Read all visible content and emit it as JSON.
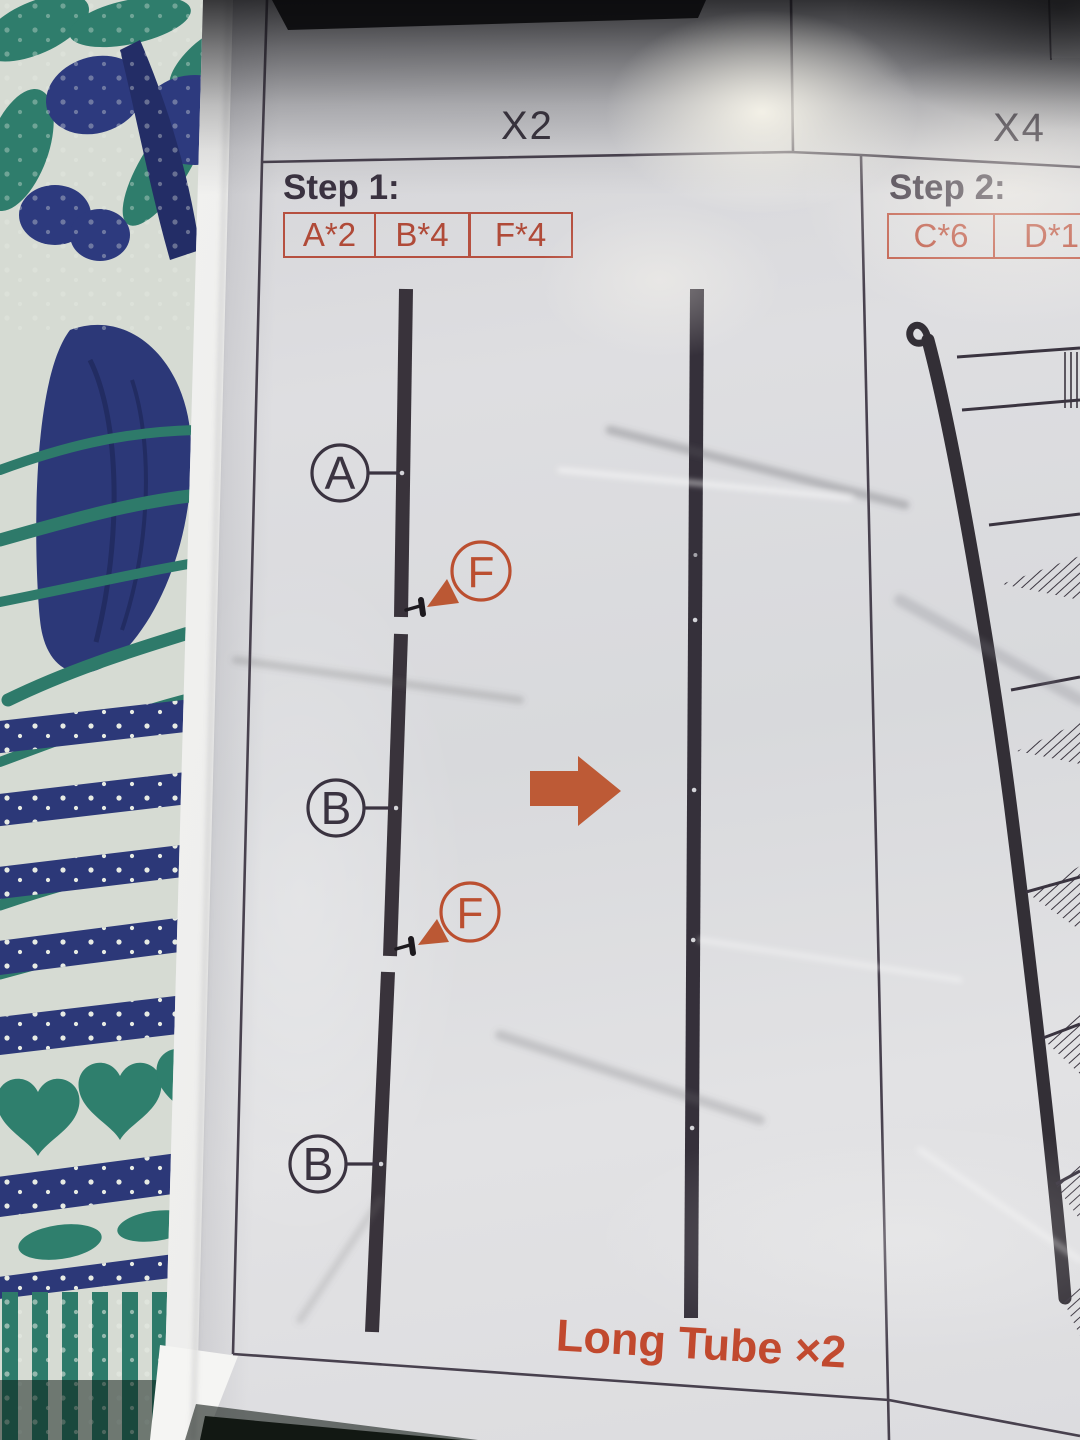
{
  "sheet": {
    "top_row": {
      "left_quantity": "X2",
      "right_quantity": "X4"
    },
    "step1": {
      "title": "Step 1:",
      "parts": [
        "A*2",
        "B*4",
        "F*4"
      ],
      "tube_callouts": [
        "A",
        "B",
        "B"
      ],
      "screw_callouts": [
        "F",
        "F"
      ],
      "caption": "Long Tube ×2"
    },
    "step2": {
      "title": "Step 2:",
      "parts": [
        "C*6",
        "D*1"
      ]
    }
  },
  "colors": {
    "accent_orange": "#b65040",
    "caption_orange": "#c1492e",
    "arrow_orange": "#bd5a36",
    "ink": "#3a3340",
    "tube": "#39333b"
  },
  "icons": {
    "assembly_direction": "right-arrow"
  }
}
